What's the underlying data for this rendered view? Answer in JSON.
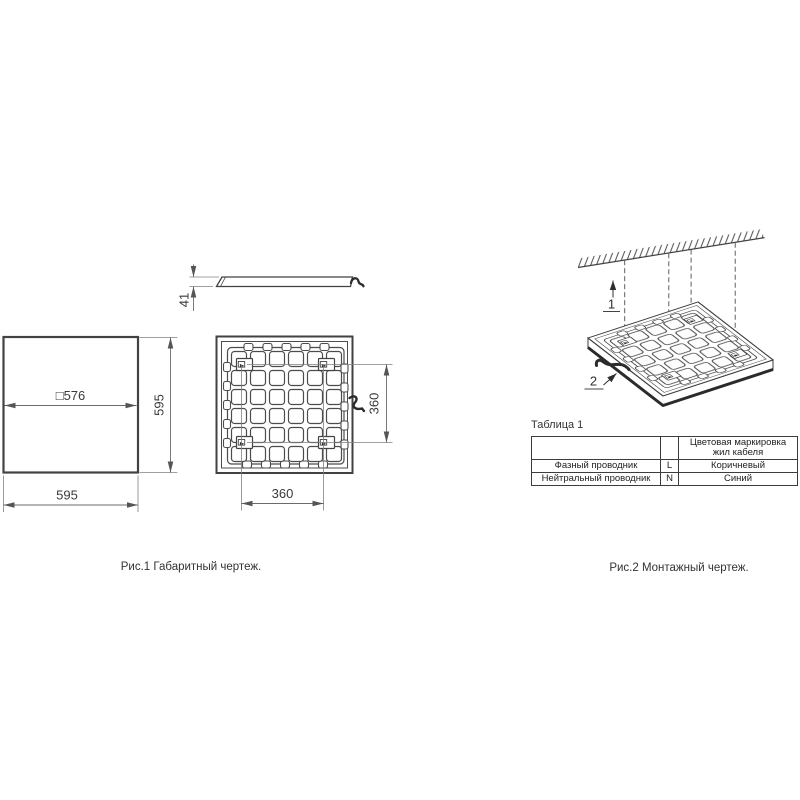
{
  "figure1": {
    "caption": "Рис.1 Габаритный чертеж.",
    "dims": {
      "profile_height": "41",
      "inner_square": "□576",
      "panel_height": "595",
      "panel_width": "595",
      "mount_spacing_vertical": "360",
      "mount_spacing_horizontal": "360"
    }
  },
  "figure2": {
    "caption": "Рис.2 Монтажный чертеж.",
    "callouts": {
      "suspension": "1",
      "luminaire": "2"
    }
  },
  "table1": {
    "title": "Таблица 1",
    "header": {
      "col3": "Цветовая маркировка жил кабеля"
    },
    "rows": [
      {
        "name": "Фазный проводник",
        "code": "L",
        "color": "Коричневый"
      },
      {
        "name": "Нейтральный проводник",
        "code": "N",
        "color": "Синий"
      }
    ]
  },
  "colors": {
    "line": "#424242",
    "dim": "#6b6b6b",
    "text": "#2f2f2f"
  }
}
